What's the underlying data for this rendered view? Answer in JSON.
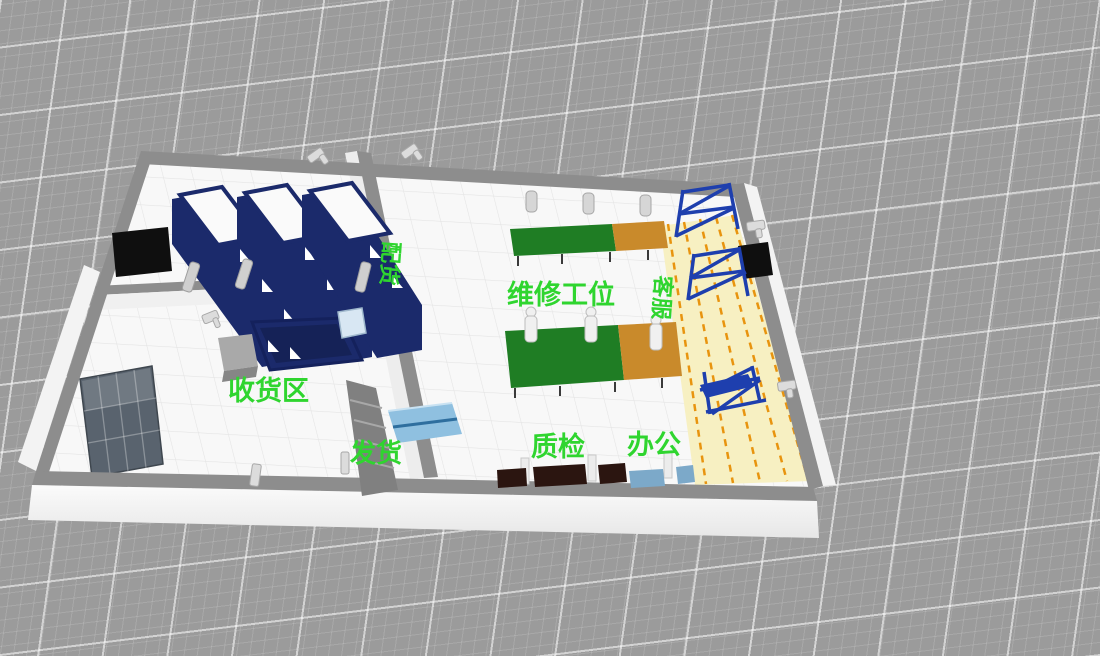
{
  "scene": {
    "areas": [
      {
        "id": "peihuo",
        "label": "配货",
        "orientation": "vertical"
      },
      {
        "id": "shouhuoqu",
        "label": "收货区",
        "orientation": "horizontal"
      },
      {
        "id": "fahuo",
        "label": "发货",
        "orientation": "horizontal"
      },
      {
        "id": "weixiu",
        "label": "维修工位",
        "orientation": "horizontal"
      },
      {
        "id": "kefu",
        "label": "客服",
        "orientation": "vertical"
      },
      {
        "id": "zhijian",
        "label": "质检",
        "orientation": "horizontal"
      },
      {
        "id": "bangong",
        "label": "办公",
        "orientation": "horizontal"
      }
    ],
    "colors": {
      "ground": "#9b9b9b",
      "grid_line": "#ffffff",
      "wall_top": "#8d8d8d",
      "wall_face": "#f3f3f3",
      "floor": "#f8f8f8",
      "rack_navy": "#1b2a6b",
      "scaffold_blue": "#1e3fae",
      "table_green": "#1f7d24",
      "table_orange": "#c98a2b",
      "table_lightblue": "#8fc0e0",
      "desk_brown": "#2b1510",
      "label_green": "#2fd52f",
      "aisle_yellow": "#f7f0c2",
      "aisle_stripe": "#e8940f",
      "panel_black": "#0f0f0f",
      "glass": "#59636e"
    }
  }
}
